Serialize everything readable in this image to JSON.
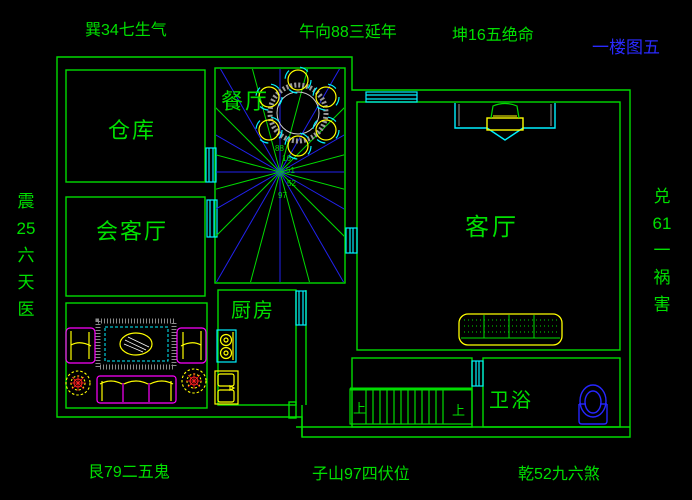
{
  "title": "一楼图五",
  "compass": {
    "top_left": "巽34七生气",
    "top_center": "午向88三延年",
    "top_right": "坤16五绝命",
    "left_vertical": "震\n25\n六\n天\n医",
    "right_vertical": "兑\n61\n一\n祸\n害",
    "bottom_left": "艮79二五鬼",
    "bottom_center": "子山97四伏位",
    "bottom_right": "乾52九六煞"
  },
  "rooms": {
    "storage": "仓库",
    "dining": "餐厅",
    "reception": "会客厅",
    "living": "客厅",
    "kitchen": "厨房",
    "bathroom": "卫浴"
  },
  "stairs": {
    "up_left": "上",
    "up_right": "上"
  },
  "fan_numbers": [
    "88",
    "16",
    "51",
    "52",
    "97"
  ],
  "colors": {
    "background": "#000000",
    "wall_green": "#00db00",
    "ray_blue": "#2222ee",
    "window_cyan": "#00f0ff",
    "furniture_yellow": "#ffff00",
    "furniture_magenta": "#ff00ff",
    "plant_red": "#ff2020",
    "table_gray": "#999999",
    "title_blue": "#2a2aff",
    "toilet_blue": "#2626ff"
  }
}
